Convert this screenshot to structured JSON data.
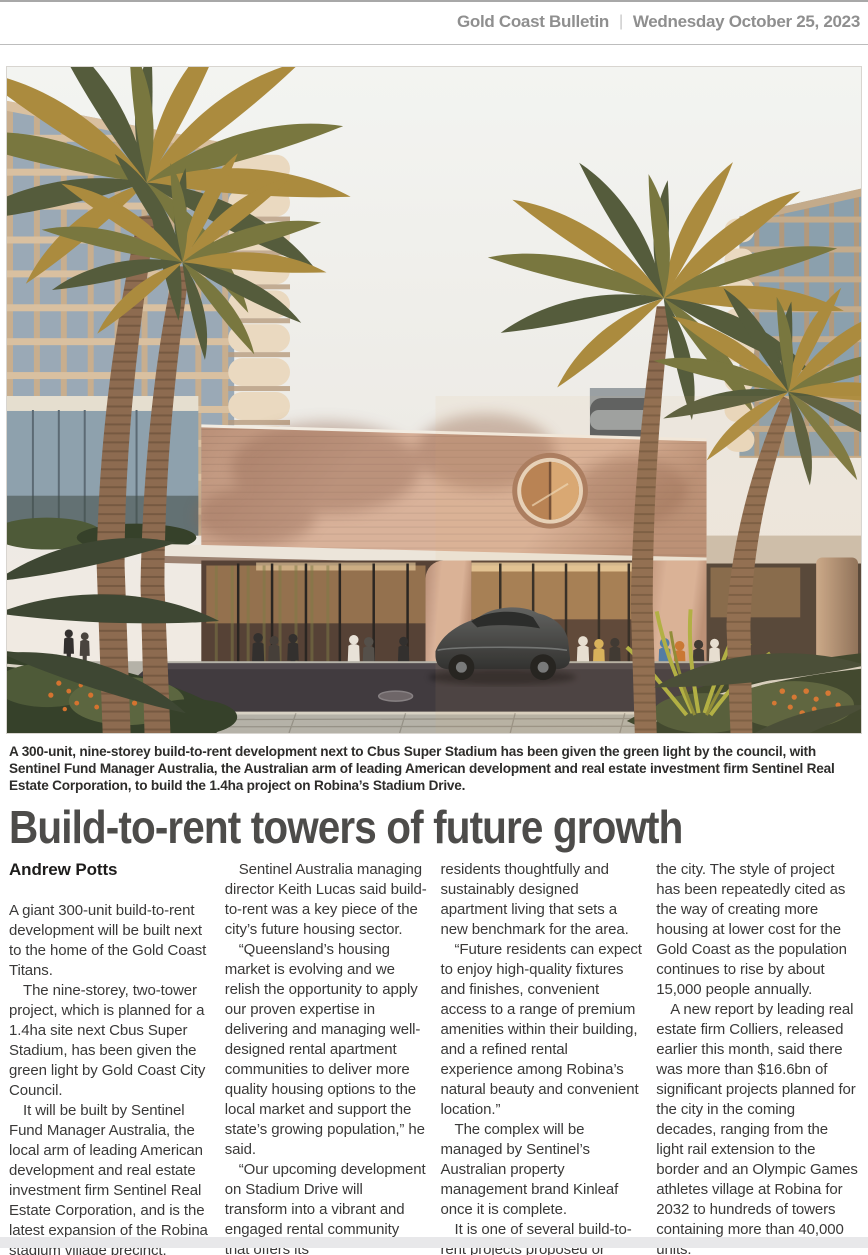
{
  "masthead": {
    "publication": "Gold Coast Bulletin",
    "separator": "|",
    "date": "Wednesday October 25, 2023"
  },
  "caption": "A 300-unit, nine-storey build-to-rent development next to Cbus Super Stadium has been given the green light by the council, with Sentinel Fund Manager Australia, the Australian arm of leading American development and real estate investment firm Sentinel Real Estate Corporation, to build the 1.4ha project on Robina’s Stadium Drive.",
  "article": {
    "headline": "Build-to-rent towers of future growth",
    "byline": "Andrew Potts",
    "columns": [
      {
        "paragraphs": [
          {
            "text": "A giant 300-unit build-to-rent development will be built next to the home of the Gold Coast Titans.",
            "indent": false
          },
          {
            "text": "The nine-storey, two-tower project, which is planned for a 1.4ha site next Cbus Super Stadium, has been given the green light by Gold Coast City Council.",
            "indent": true
          },
          {
            "text": "It will be built by Sentinel Fund Manager Australia, the local arm of leading American development and real estate investment firm Sentinel Real Estate Corporation, and is the latest expansion of the Robina stadium village precinct.",
            "indent": true
          }
        ]
      },
      {
        "paragraphs": [
          {
            "text": "Sentinel Australia managing director Keith Lucas said build-to-rent was a key piece of the city’s future housing sector.",
            "indent": true
          },
          {
            "text": "“Queensland’s housing market is evolving and we relish the opportunity to apply our proven expertise in delivering and managing well-designed rental apartment communities to deliver more quality housing options to the local market and support the state’s growing population,” he said.",
            "indent": true
          },
          {
            "text": "“Our upcoming development on Stadium Drive will transform into a vibrant and engaged rental community that offers its",
            "indent": true
          }
        ]
      },
      {
        "paragraphs": [
          {
            "text": "residents thoughtfully and sustainably designed apartment living that sets a new benchmark for the area.",
            "indent": false
          },
          {
            "text": "“Future residents can expect to enjoy high-quality fixtures and finishes, convenient access to a range of premium amenities within their building, and a refined rental experience among Robina’s natural beauty and convenient location.”",
            "indent": true
          },
          {
            "text": "The complex will be managed by Sentinel’s Australian property management brand Kinleaf once it is complete.",
            "indent": true
          },
          {
            "text": "It is one of several build-to-rent projects proposed or under construction across",
            "indent": true
          }
        ]
      },
      {
        "paragraphs": [
          {
            "text": "the city. The style of project has been repeatedly cited as the way of creating more housing at lower cost for the Gold Coast as the population continues to rise by about 15,000 people annually.",
            "indent": false
          },
          {
            "text": "A new report by leading real estate firm Colliers, released earlier this month, said there was more than $16.6bn of significant projects planned for the city in the coming decades, ranging from the light rail extension to the border and an Olympic Games athletes village at Robina for 2032 to hundreds of towers containing more than 40,000 units.",
            "indent": true
          }
        ]
      }
    ]
  },
  "theme": {
    "pageBg": "#ffffff",
    "headerText": "#8f8f8f",
    "headerRule": "#a8a8a8",
    "ruleLight": "#bdbdbd",
    "captionInk": "#2e2d2b",
    "headlineInk": "#4d4c4a",
    "bodyInk": "#3a3938",
    "bylineInk": "#1d1c1b",
    "bottomBar": "#e8e8ea",
    "photoBorder": "#d8d5d0"
  },
  "photo": {
    "palette": {
      "sky1": "#f3f4f1",
      "sky2": "#edebe6",
      "sky3": "#f1e9e0",
      "facade": "#9aa9b6",
      "frame": "#c8ae8e",
      "slab": "#d9c0a0",
      "facadeB": "#8ba0ad",
      "frameB": "#b2997c",
      "slabB": "#c4ab8b",
      "balcony": "#ead9c0",
      "balconyShadow": "#b89c7e",
      "grayBldg": "#9aa0a3",
      "grayBldgDark": "#565c60",
      "brick": "#d9b29a",
      "brickDark": "#b98f77",
      "roofEdge": "#f2ece2",
      "canopy": "#ece5da",
      "soffit": "#8d705d",
      "interior": "#564236",
      "glow": "#d2a066",
      "glowBright": "#f2d6a6",
      "mullion": "#2b2622",
      "palmGold": "#ab8b3e",
      "palmOlive": "#79773f",
      "palmDark": "#555c3c",
      "palmShadow": "#3e4733",
      "trunk": "#8d6b50",
      "trunkDark": "#6e523c",
      "paving": "#b5b2a8",
      "pavingJoint": "#5f584c",
      "asphalt": "#413b3f",
      "asphaltLight": "#5a5356",
      "curb": "#d8d2c4",
      "shrub": "#4e5a38",
      "shrubDark": "#36412a",
      "blade": "#aeb040",
      "flower": "#d4732f",
      "carBody": "#43474a",
      "carDark": "#24282b",
      "carGlass": "#1d2225",
      "carRim": "#70767b",
      "personDark": "#33302e",
      "personWhite": "#e8e2d8",
      "personBlue": "#4879a8",
      "personOrange": "#c8742f",
      "personYellow": "#d8b25a"
    }
  }
}
